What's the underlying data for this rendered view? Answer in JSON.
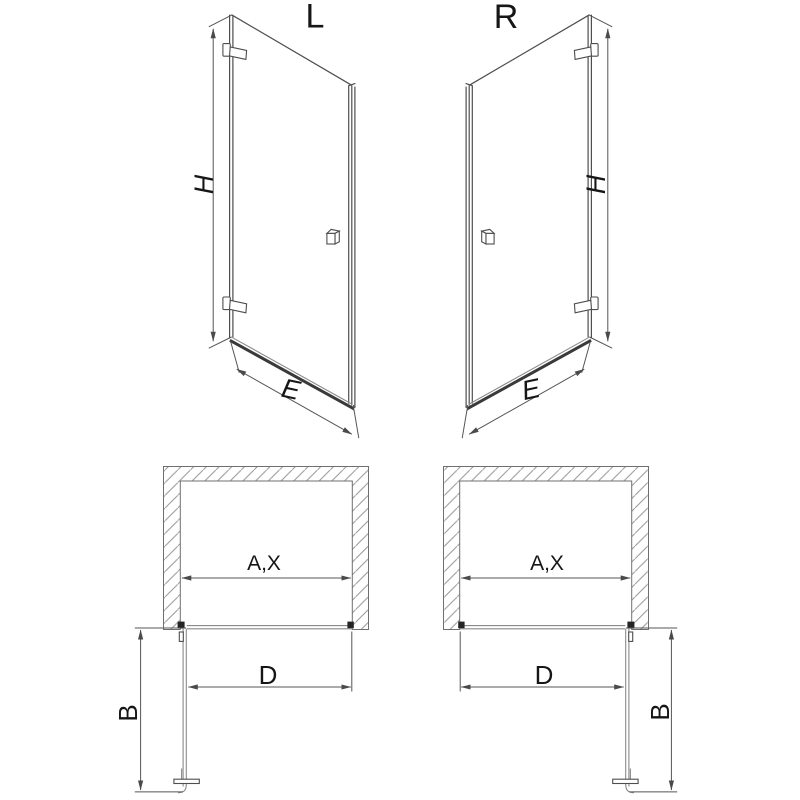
{
  "page": {
    "background": "#ffffff",
    "type": "technical-drawing",
    "subject": "shower door, left and right hinged variants, elevation and plan views with dimension letters"
  },
  "colors": {
    "line": "#4e4e4e",
    "dimension_line": "#555555",
    "hatch": "#969696",
    "fitting_black": "#242424",
    "text": "#161616"
  },
  "views": {
    "elevation_left": {
      "label": "L",
      "dim_height": "H",
      "dim_width": "E"
    },
    "elevation_right": {
      "label": "R",
      "dim_height": "H",
      "dim_width": "E"
    },
    "plan_left": {
      "dim_opening": "A,X",
      "dim_passage": "D",
      "dim_depth": "B"
    },
    "plan_right": {
      "dim_opening": "A,X",
      "dim_passage": "D",
      "dim_depth": "B"
    }
  }
}
